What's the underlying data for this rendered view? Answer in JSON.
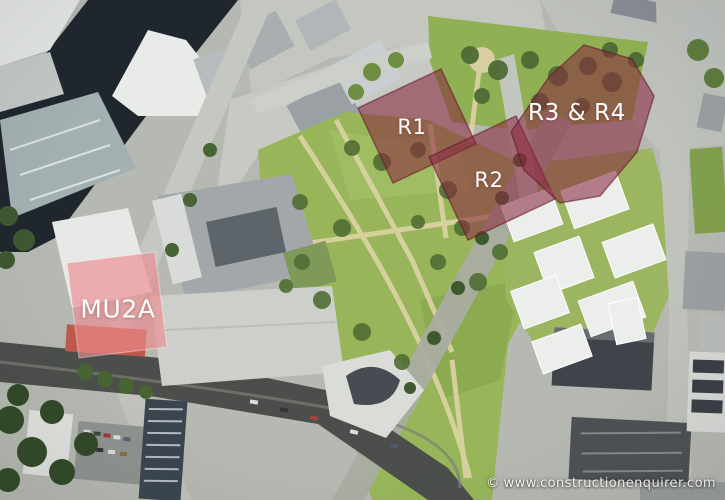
{
  "overlay": {
    "label_color": "#FFFFFF",
    "plots": {
      "r1": {
        "label": "R1",
        "fill": "#8E2840"
      },
      "r2": {
        "label": "R2",
        "fill": "#8E2840"
      },
      "r3r4": {
        "label": "R3 & R4",
        "fill": "#8E2840"
      },
      "mu2a": {
        "label": "MU2A",
        "fill": "#F08A8F"
      }
    }
  },
  "watermark": {
    "symbol": "©",
    "text": "www.constructionenquirer.com"
  },
  "scene_colors": {
    "park_green": "#97B754",
    "river": "#20262E",
    "railway": "#4B4E4A"
  }
}
